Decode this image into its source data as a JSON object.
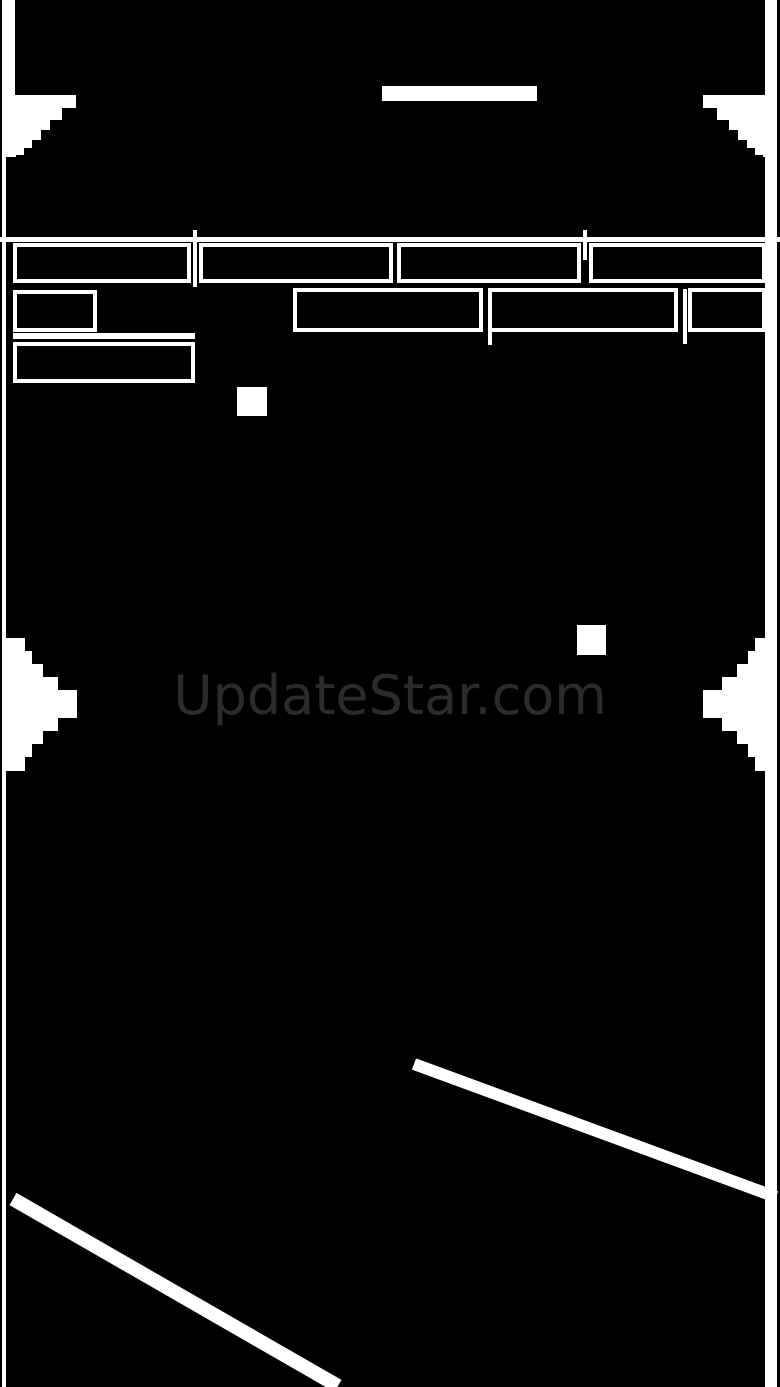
{
  "canvas": {
    "width": 780,
    "height": 1387,
    "background": "#000000",
    "foreground": "#ffffff"
  },
  "watermark": {
    "text": "UpdateStar.com",
    "color": "#2b2b2b"
  },
  "scene": {
    "brick_outline_count": 9,
    "powerup_square_count": 2,
    "laser_line_count": 2
  }
}
